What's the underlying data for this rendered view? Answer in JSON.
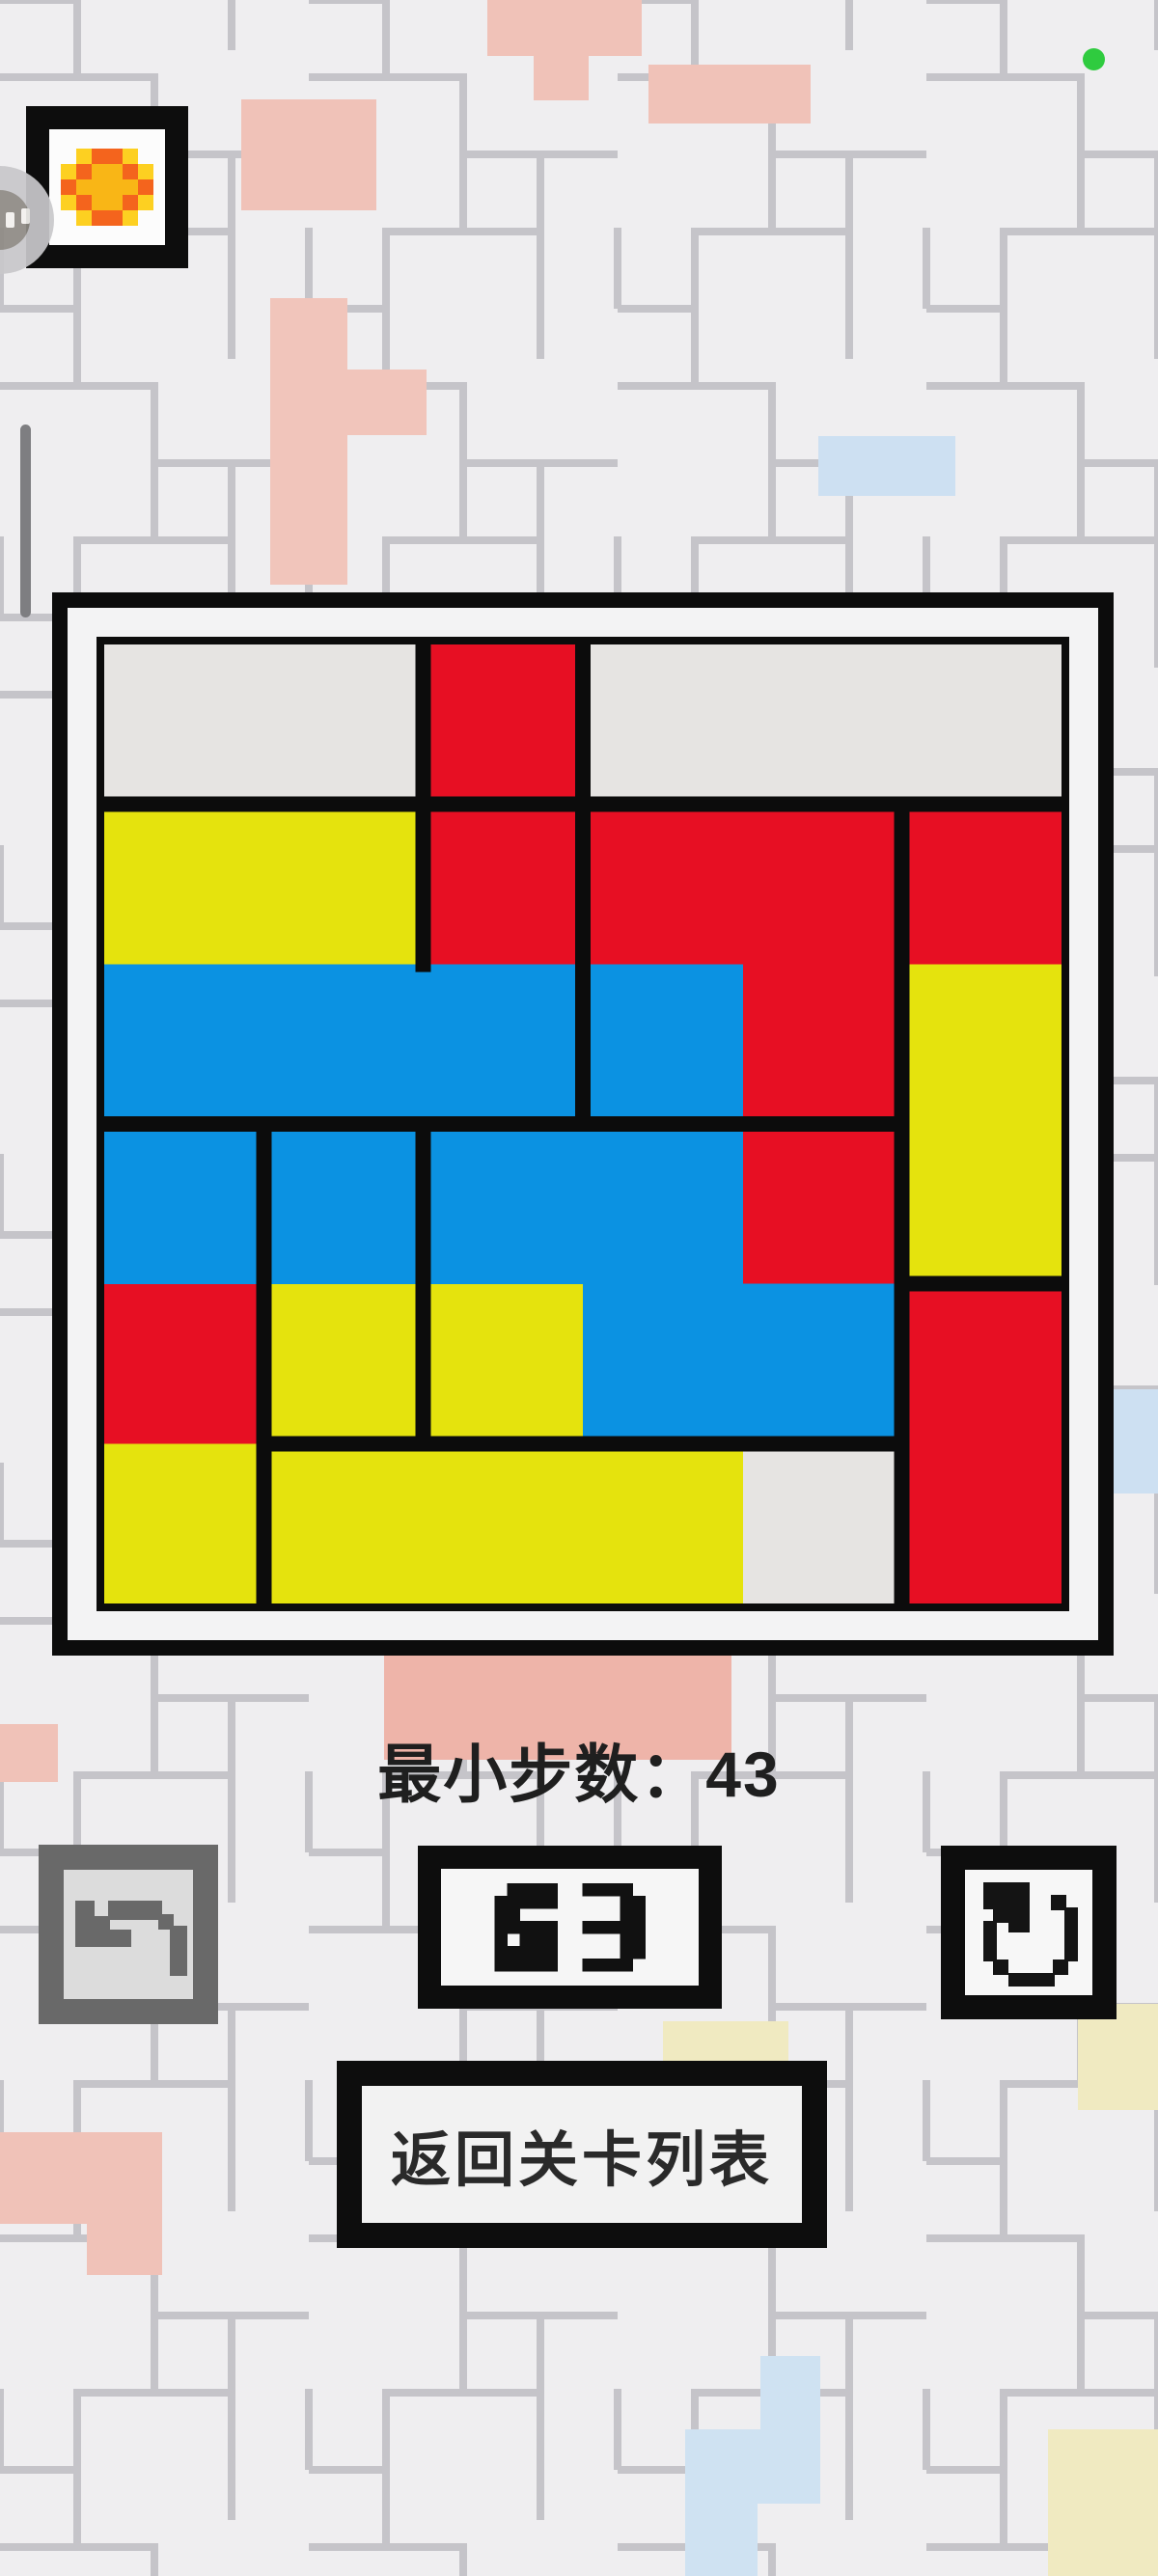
{
  "status": {
    "recording_indicator_icon": "green-dot-icon",
    "recording_indicator_color": "#2fcb3f"
  },
  "top_bar": {
    "sun_button_icon": "pixel-sun-icon",
    "assist_handle_icon": "floating-assist-icon"
  },
  "board": {
    "rows": 6,
    "cols": 6,
    "colors": {
      "red": "#e70f23",
      "blue": "#0b92e2",
      "yellow": "#e5e30d",
      "empty": "#e6e4e2",
      "line": "#0c0c0c",
      "frame_white": "#f3f3f4"
    },
    "pieces": [
      {
        "color": "red",
        "cells": [
          [
            1,
            3
          ]
        ]
      },
      {
        "color": "red",
        "cells": [
          [
            2,
            3
          ]
        ]
      },
      {
        "color": "red",
        "cells": [
          [
            2,
            4
          ],
          [
            2,
            5
          ],
          [
            3,
            5
          ]
        ]
      },
      {
        "color": "red",
        "cells": [
          [
            2,
            6
          ]
        ]
      },
      {
        "color": "red",
        "cells": [
          [
            4,
            5
          ]
        ]
      },
      {
        "color": "red",
        "cells": [
          [
            5,
            1
          ]
        ]
      },
      {
        "color": "red",
        "cells": [
          [
            5,
            6
          ],
          [
            6,
            6
          ]
        ]
      },
      {
        "color": "yellow",
        "cells": [
          [
            2,
            1
          ],
          [
            2,
            2
          ]
        ]
      },
      {
        "color": "yellow",
        "cells": [
          [
            3,
            6
          ],
          [
            4,
            6
          ]
        ]
      },
      {
        "color": "yellow",
        "cells": [
          [
            5,
            2
          ]
        ]
      },
      {
        "color": "yellow",
        "cells": [
          [
            5,
            3
          ]
        ]
      },
      {
        "color": "yellow",
        "cells": [
          [
            6,
            1
          ]
        ]
      },
      {
        "color": "yellow",
        "cells": [
          [
            6,
            2
          ],
          [
            6,
            3
          ],
          [
            6,
            4
          ]
        ]
      },
      {
        "color": "blue",
        "cells": [
          [
            3,
            1
          ],
          [
            3,
            2
          ],
          [
            3,
            3
          ]
        ]
      },
      {
        "color": "blue",
        "cells": [
          [
            3,
            4
          ]
        ]
      },
      {
        "color": "blue",
        "cells": [
          [
            4,
            1
          ]
        ]
      },
      {
        "color": "blue",
        "cells": [
          [
            4,
            2
          ]
        ]
      },
      {
        "color": "blue",
        "cells": [
          [
            4,
            3
          ],
          [
            4,
            4
          ],
          [
            5,
            4
          ],
          [
            5,
            5
          ]
        ]
      }
    ],
    "empty_cells": [
      [
        1,
        1
      ],
      [
        1,
        2
      ],
      [
        1,
        4
      ],
      [
        1,
        5
      ],
      [
        1,
        6
      ],
      [
        6,
        5
      ]
    ],
    "border_lines": {
      "horizontal": [
        {
          "y": 1,
          "from_col": 1,
          "to_col": 6
        },
        {
          "y": 3,
          "from_col": 1,
          "to_col": 5
        },
        {
          "y": 4,
          "from_col": 6,
          "to_col": 6
        },
        {
          "y": 5,
          "from_col": 2,
          "to_col": 5
        }
      ],
      "vertical": [
        {
          "x": 1,
          "from_row": 4,
          "to_row": 6
        },
        {
          "x": 2,
          "from_row": 1,
          "to_row": 2
        },
        {
          "x": 2,
          "from_row": 4,
          "to_row": 5
        },
        {
          "x": 3,
          "from_row": 1,
          "to_row": 3
        },
        {
          "x": 5,
          "from_row": 2,
          "to_row": 6
        }
      ]
    }
  },
  "stats": {
    "min_steps_label": "最小步数：",
    "min_steps_value": "43"
  },
  "controls": {
    "undo_button": {
      "icon": "pixel-undo-arrow-icon",
      "enabled": false
    },
    "move_counter": {
      "value": "63"
    },
    "restart_button": {
      "icon": "pixel-restart-arrow-icon"
    },
    "back_button": {
      "label": "返回关卡列表"
    }
  }
}
